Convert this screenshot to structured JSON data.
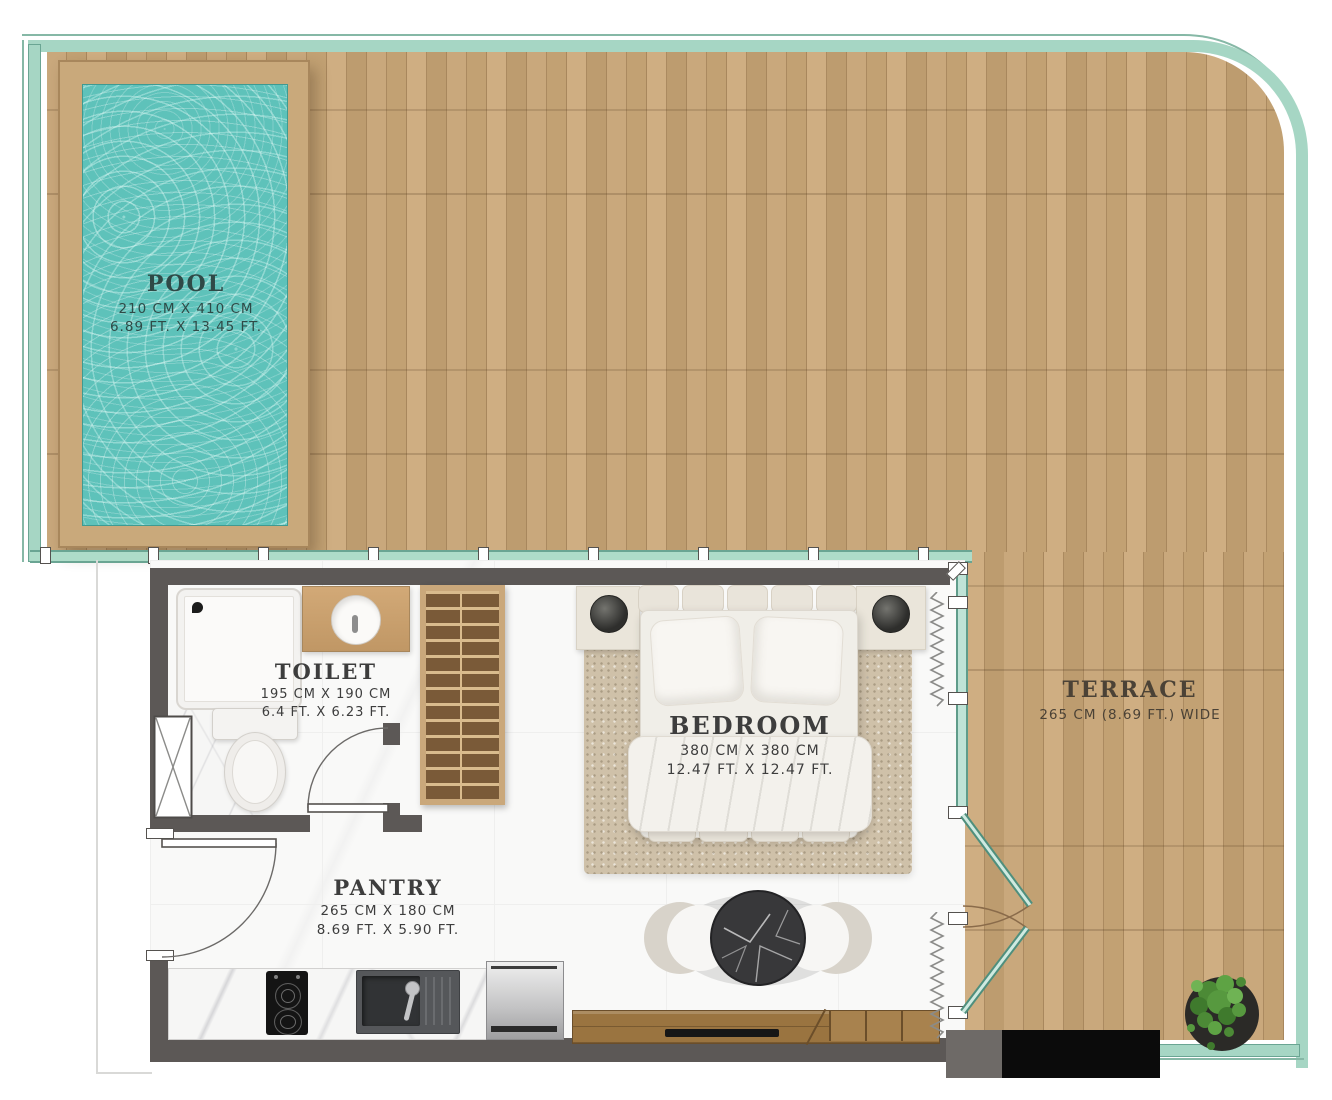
{
  "plan_title": "Studio villa floor plan with pool and terrace",
  "rooms": {
    "pool": {
      "title": "POOL",
      "dim_cm": "210 CM X 410 CM",
      "dim_ft": "6.89 FT. X 13.45 FT."
    },
    "toilet": {
      "title": "TOILET",
      "dim_cm": "195 CM X 190 CM",
      "dim_ft": "6.4 FT. X 6.23 FT."
    },
    "bedroom": {
      "title": "BEDROOM",
      "dim_cm": "380 CM X 380 CM",
      "dim_ft": "12.47 FT. X 12.47 FT."
    },
    "pantry": {
      "title": "PANTRY",
      "dim_cm": "265 CM X 180 CM",
      "dim_ft": "8.69 FT. X 5.90 FT."
    },
    "terrace": {
      "title": "TERRACE",
      "dim": "265 CM (8.69 FT.) WIDE"
    }
  },
  "colors": {
    "railing_glass": "#a6d6c4",
    "deck_wood": "#c2a173",
    "wall": "#5c5856",
    "pool_water": "#5ec2ba",
    "label_text": "#3d3d3d",
    "pool_text": "#2f4a47",
    "terrace_text": "#4b4236"
  }
}
